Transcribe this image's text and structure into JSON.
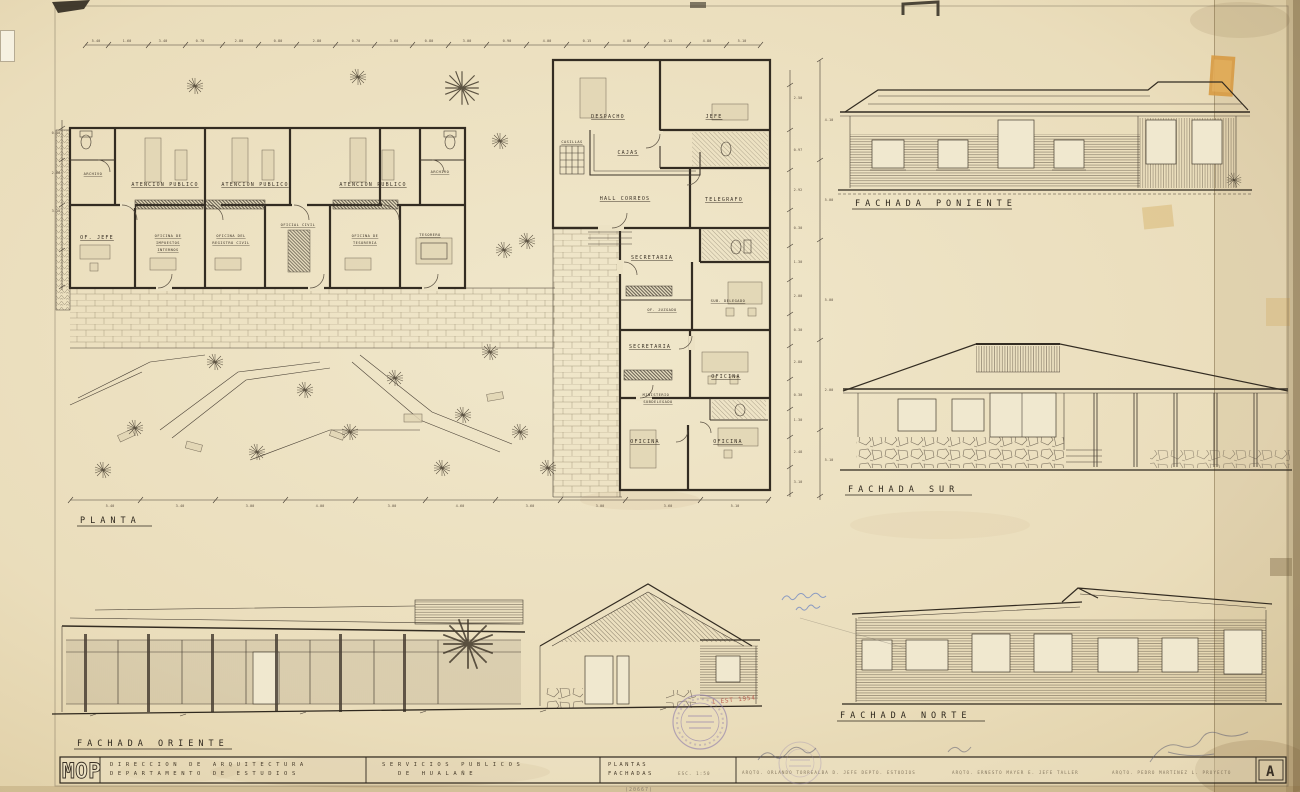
{
  "labels": {
    "planta": "PLANTA",
    "fachada_poniente": "FACHADA PONIENTE",
    "fachada_sur": "FACHADA SUR",
    "fachada_oriente": "FACHADA ORIENTE",
    "fachada_norte": "FACHADA NORTE"
  },
  "rooms": {
    "archivo_left": "ARCHIVO",
    "archivo_right": "ARCHIVO",
    "atencion_publico": "ATENCION PUBLICO",
    "of_jefe": "OF. JEFE",
    "imp_l1": "OFICINA DE",
    "imp_l2": "IMPUESTOS",
    "imp_l3": "INTERNOS",
    "reg_l1": "OFICINA DEL",
    "reg_l2": "REGISTRO CIVIL",
    "oficial_civil": "OFICIAL CIVIL",
    "tes_l1": "OFICINA DE",
    "tes_l2": "TESORERIA",
    "tesorero": "TESORERO",
    "despacho": "DESPACHO",
    "jefe": "JEFE",
    "cajas": "CAJAS",
    "casillas": "CASILLAS",
    "hall_correos": "HALL CORREOS",
    "telegrafo": "TELEGRAFO",
    "secretaria_1": "SECRETARIA",
    "sub_delegado": "SUB. DELEGADO",
    "of_juzgado": "OF. JUZGADO",
    "secretaria_2": "SECRETARIA",
    "oficina_1": "OFICINA",
    "min_l1": "MINISTERIO",
    "min_l2": "SUBDELEGADO",
    "oficina_2": "OFICINA",
    "oficina_3": "OFICINA"
  },
  "titleblock": {
    "logo": "MOP",
    "org_line1": "DIRECCION DE ARQUITECTURA",
    "org_line2": "DEPARTAMENTO DE ESTUDIOS",
    "project_line1": "SERVICIOS PUBLICOS",
    "project_line2": "DE HUALAÑE",
    "content_line1": "PLANTAS",
    "content_line2": "FACHADAS",
    "scale": "ESC. 1:50",
    "sig_1": "ARQTO. ORLANDO TORREALBA D.  JEFE DEPTO. ESTUDIOS",
    "sig_2": "ARQTO. ERNESTO MAYER E.  JEFE TALLER",
    "sig_3": "ARQTO. PEDRO MARTINEZ L.  PROYECTO",
    "stamp_monogram": "A"
  },
  "annotations": {
    "date_stamp": "1 EST 1954",
    "pencil_number": "(20667)"
  },
  "dims": {
    "top": [
      {
        "x": 96,
        "y": 42,
        "t": "5.40"
      },
      {
        "x": 127,
        "y": 42,
        "t": "1.60"
      },
      {
        "x": 163,
        "y": 42,
        "t": "3.40"
      },
      {
        "x": 200,
        "y": 42,
        "t": "0.70"
      },
      {
        "x": 239,
        "y": 42,
        "t": "2.80"
      },
      {
        "x": 278,
        "y": 42,
        "t": "0.80"
      },
      {
        "x": 317,
        "y": 42,
        "t": "2.80"
      },
      {
        "x": 356,
        "y": 42,
        "t": "0.70"
      },
      {
        "x": 394,
        "y": 42,
        "t": "3.60"
      },
      {
        "x": 429,
        "y": 42,
        "t": "0.80"
      },
      {
        "x": 467,
        "y": 42,
        "t": "3.00"
      },
      {
        "x": 507,
        "y": 42,
        "t": "0.90"
      },
      {
        "x": 547,
        "y": 42,
        "t": "4.00"
      },
      {
        "x": 587,
        "y": 42,
        "t": "0.15"
      },
      {
        "x": 627,
        "y": 42,
        "t": "4.00"
      },
      {
        "x": 668,
        "y": 42,
        "t": "0.15"
      },
      {
        "x": 707,
        "y": 42,
        "t": "4.80"
      },
      {
        "x": 742,
        "y": 42,
        "t": "5.10"
      }
    ],
    "right": [
      {
        "x": 798,
        "y": 99,
        "t": "2.50"
      },
      {
        "x": 798,
        "y": 151,
        "t": "0.97"
      },
      {
        "x": 798,
        "y": 191,
        "t": "2.92"
      },
      {
        "x": 798,
        "y": 229,
        "t": "0.30"
      },
      {
        "x": 798,
        "y": 263,
        "t": "1.30"
      },
      {
        "x": 798,
        "y": 297,
        "t": "2.00"
      },
      {
        "x": 798,
        "y": 331,
        "t": "0.30"
      },
      {
        "x": 798,
        "y": 363,
        "t": "2.80"
      },
      {
        "x": 798,
        "y": 396,
        "t": "0.30"
      },
      {
        "x": 798,
        "y": 421,
        "t": "1.30"
      },
      {
        "x": 798,
        "y": 453,
        "t": "2.48"
      },
      {
        "x": 798,
        "y": 483,
        "t": "3.10"
      },
      {
        "x": 829,
        "y": 121,
        "t": "4.10"
      },
      {
        "x": 829,
        "y": 201,
        "t": "5.00"
      },
      {
        "x": 829,
        "y": 301,
        "t": "5.00"
      },
      {
        "x": 829,
        "y": 391,
        "t": "2.00"
      },
      {
        "x": 829,
        "y": 461,
        "t": "5.10"
      }
    ],
    "bottom": [
      {
        "x": 110,
        "y": 507,
        "t": "5.40"
      },
      {
        "x": 180,
        "y": 507,
        "t": "3.40"
      },
      {
        "x": 250,
        "y": 507,
        "t": "3.00"
      },
      {
        "x": 320,
        "y": 507,
        "t": "4.00"
      },
      {
        "x": 392,
        "y": 507,
        "t": "3.00"
      },
      {
        "x": 460,
        "y": 507,
        "t": "4.60"
      },
      {
        "x": 530,
        "y": 507,
        "t": "3.60"
      },
      {
        "x": 600,
        "y": 507,
        "t": "3.00"
      },
      {
        "x": 668,
        "y": 507,
        "t": "3.60"
      },
      {
        "x": 735,
        "y": 507,
        "t": "5.10"
      }
    ],
    "left": [
      {
        "x": 56,
        "y": 134,
        "t": "0.40"
      },
      {
        "x": 56,
        "y": 174,
        "t": "2.98"
      },
      {
        "x": 56,
        "y": 212,
        "t": "3.10"
      }
    ]
  }
}
